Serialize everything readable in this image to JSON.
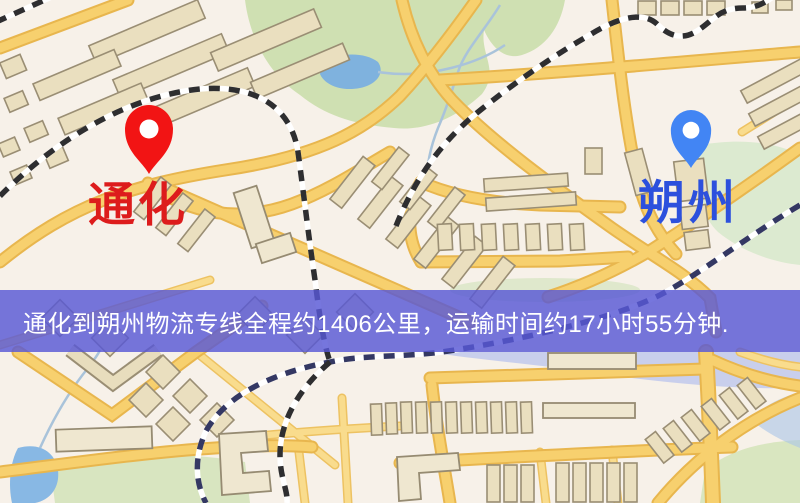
{
  "map": {
    "origin": {
      "name": "通化",
      "label_color": "#dd1c1c",
      "pin_color": "#f21414"
    },
    "destination": {
      "name": "朔州",
      "label_color": "#2c50dd",
      "pin_color": "#4285f4"
    },
    "banner": {
      "text": "通化到朔州物流专线全程约1406公里，运输时间约17小时55分钟.",
      "background": "rgba(88,88,214,0.82)",
      "text_color": "#ffffff"
    },
    "legend_colors": {
      "background": "#f7f1e9",
      "road": "#f7d06e",
      "building": "#eadfbf",
      "park": "#cfe0b2",
      "water": "#7fb2de",
      "railway": "#2e2e30"
    }
  }
}
